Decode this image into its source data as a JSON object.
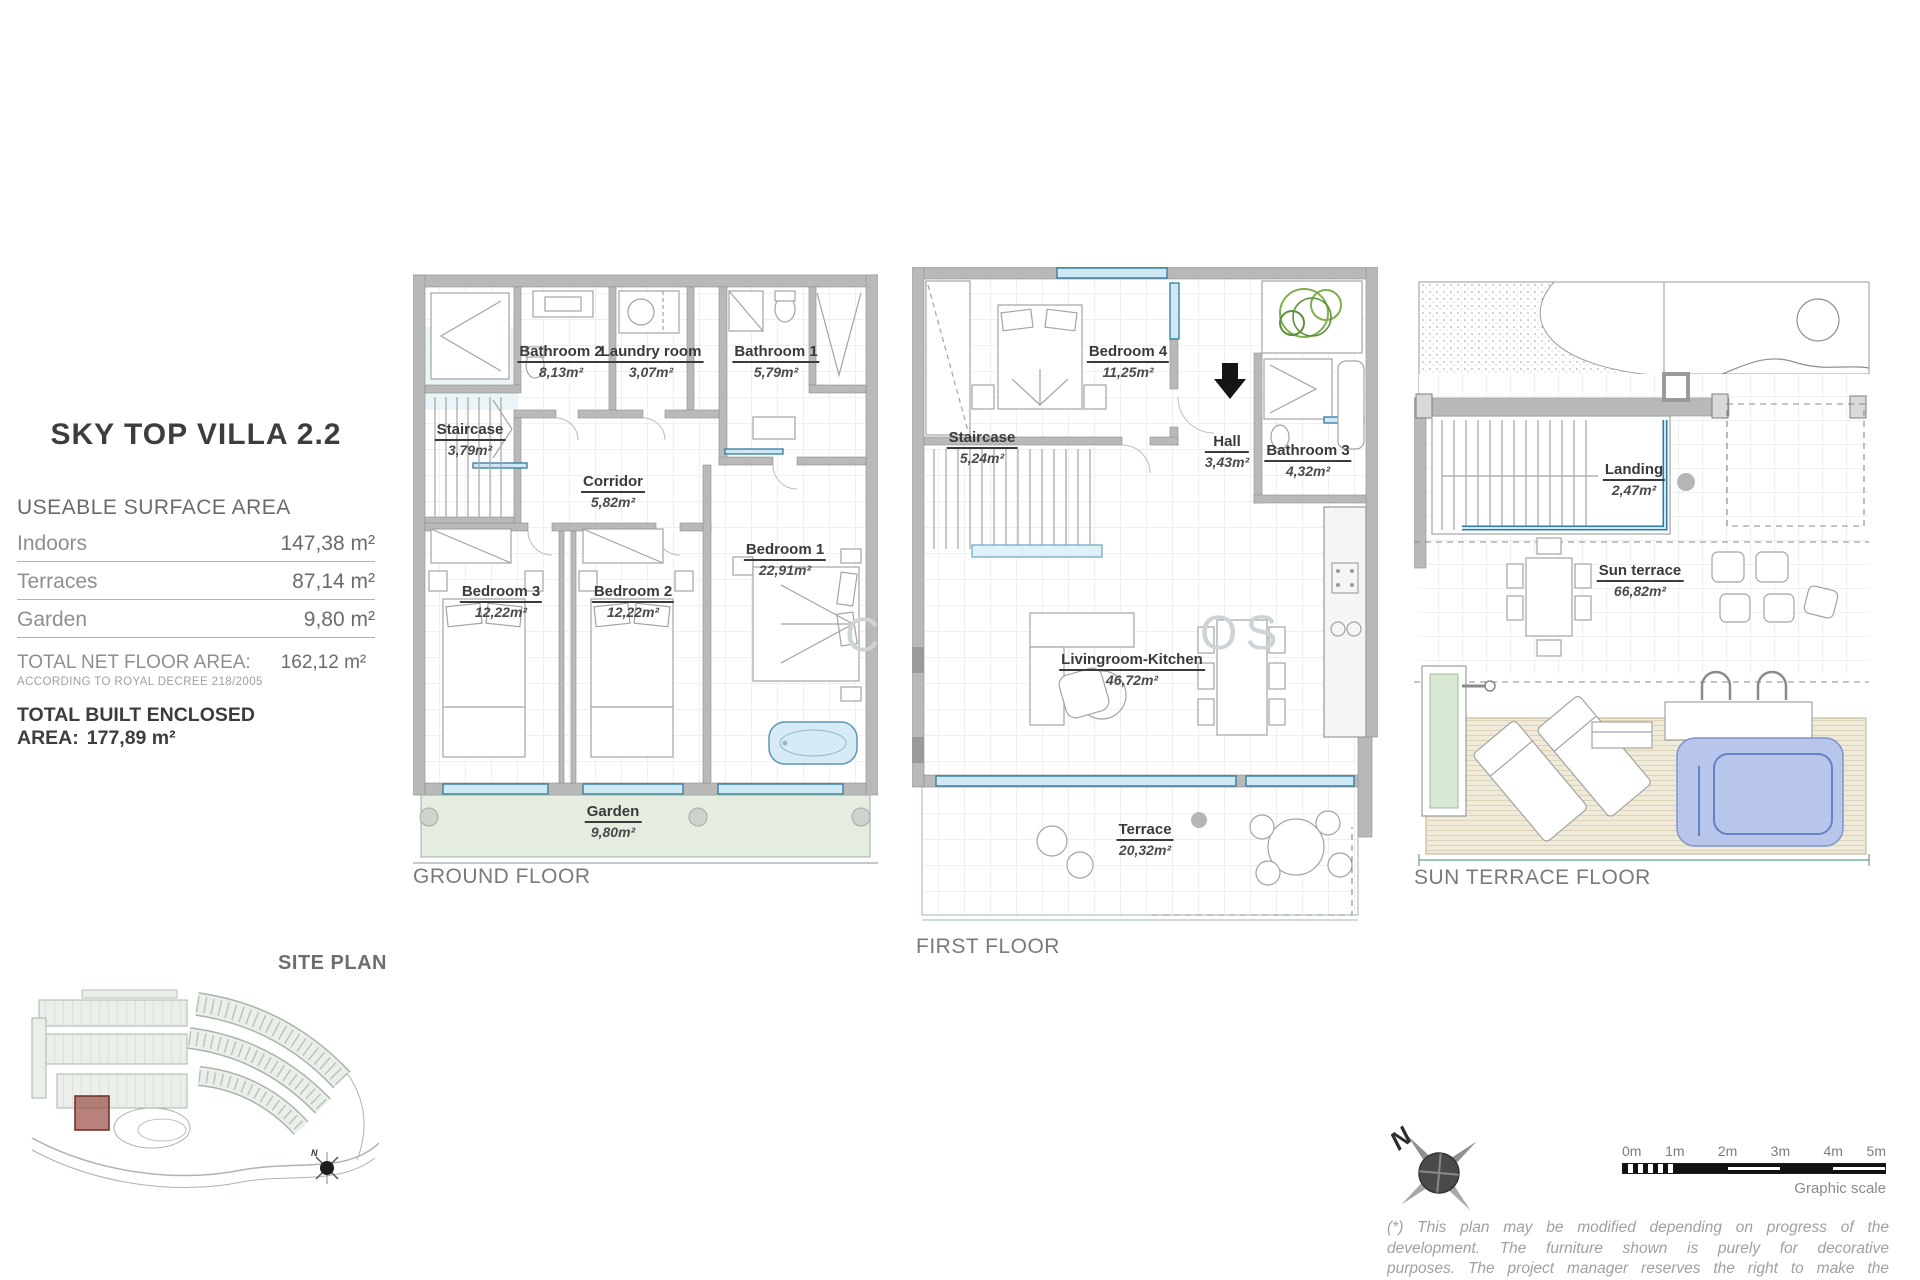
{
  "info_panel": {
    "title": "SKY TOP VILLA 2.2",
    "section_title": "USEABLE SURFACE AREA",
    "rows": [
      {
        "label": "Indoors",
        "value": "147,38 m²"
      },
      {
        "label": "Terraces",
        "value": "87,14 m²"
      },
      {
        "label": "Garden",
        "value": "9,80 m²"
      }
    ],
    "total_net": {
      "label": "TOTAL NET FLOOR AREA:",
      "value": "162,12  m²",
      "note": "ACCORDING TO ROYAL DECREE 218/2005"
    },
    "total_built": {
      "label": "TOTAL BUILT ENCLOSED AREA:",
      "value": "177,89 m²"
    }
  },
  "floors": {
    "ground": {
      "name": "GROUND FLOOR",
      "rooms": [
        {
          "name": "Bathroom 2",
          "area": "8,13m²"
        },
        {
          "name": "Laundry room",
          "area": "3,07m²"
        },
        {
          "name": "Bathroom 1",
          "area": "5,79m²"
        },
        {
          "name": "Staircase",
          "area": "3,79m²"
        },
        {
          "name": "Corridor",
          "area": "5,82m²"
        },
        {
          "name": "Bedroom 3",
          "area": "12,22m²"
        },
        {
          "name": "Bedroom 2",
          "area": "12,22m²"
        },
        {
          "name": "Bedroom 1",
          "area": "22,91m²"
        },
        {
          "name": "Garden",
          "area": "9,80m²"
        }
      ]
    },
    "first": {
      "name": "FIRST FLOOR",
      "rooms": [
        {
          "name": "Bedroom 4",
          "area": "11,25m²"
        },
        {
          "name": "Staircase",
          "area": "5,24m²"
        },
        {
          "name": "Hall",
          "area": "3,43m²"
        },
        {
          "name": "Bathroom 3",
          "area": "4,32m²"
        },
        {
          "name": "Livingroom-Kitchen",
          "area": "46,72m²"
        },
        {
          "name": "Terrace",
          "area": "20,32m²"
        }
      ]
    },
    "sun": {
      "name": "SUN TERRACE FLOOR",
      "rooms": [
        {
          "name": "Landing",
          "area": "2,47m²"
        },
        {
          "name": "Sun terrace",
          "area": "66,82m²"
        }
      ]
    }
  },
  "site_plan": {
    "label": "SITE PLAN"
  },
  "compass": {
    "label": "N"
  },
  "scale_bar": {
    "ticks": [
      "0m",
      "1m",
      "2m",
      "3m",
      "4m",
      "5m"
    ],
    "caption": "Graphic scale"
  },
  "watermark": {
    "left": "C",
    "right": "OS"
  },
  "disclaimer": "(*) This plan may be modified depending on progress of the development. The furniture shown is purely for decorative purposes. The project manager reserves the right to make the necessary changes for any possible functional, aesthetic and legal reasons without this",
  "colors": {
    "wall": "#b9b9b9",
    "window_blue": "#2f7a9e",
    "garden_green": "#e4eddf",
    "deck_beige": "#f0ead9",
    "pool_blue": "#b9c6ec",
    "site_unit_red": "#9c5148"
  }
}
